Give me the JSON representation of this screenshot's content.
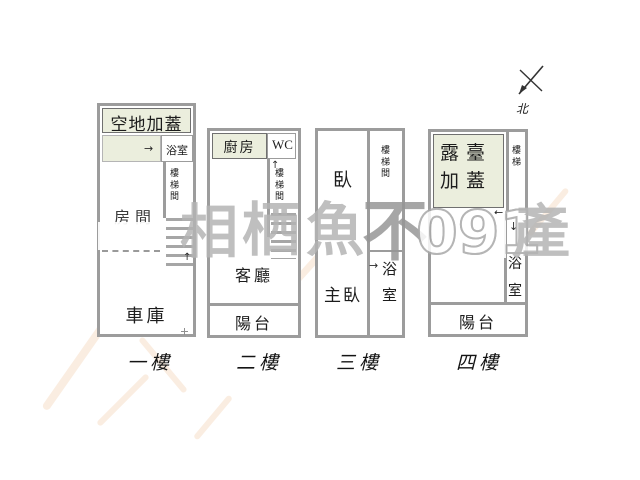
{
  "compass": {
    "north_label": "北"
  },
  "floors": {
    "f1": {
      "name": "一樓",
      "vacant_roof": "空地加蓋",
      "bathroom": "浴室",
      "stairwell": "樓梯間",
      "room": "房間",
      "garage": "車庫"
    },
    "f2": {
      "name": "二樓",
      "kitchen": "廚房",
      "wc": "WC",
      "stairwell": "樓梯間",
      "living_room": "客廳",
      "balcony": "陽台"
    },
    "f3": {
      "name": "三樓",
      "bedroom": "臥",
      "master_bedroom": "主臥",
      "stairwell": "樓梯間",
      "bathroom": "浴室"
    },
    "f4": {
      "name": "四樓",
      "terrace_roof": "露臺加蓋",
      "stairs": "樓梯",
      "bathroom": "浴室",
      "balcony": "陽台"
    }
  },
  "arrows": {
    "right": "→",
    "left": "←",
    "up": "↑",
    "down": "↓"
  },
  "watermark": {
    "char1": "相",
    "char2": "栖",
    "char3": "魚",
    "char4": "不",
    "digits": "091",
    "char5": "產"
  },
  "colors": {
    "wall": "#9c9c9c",
    "green_fill": "#ebeedd",
    "watermark_gray": "#b4b4b4",
    "peach_stroke": "#f3d7bd"
  }
}
